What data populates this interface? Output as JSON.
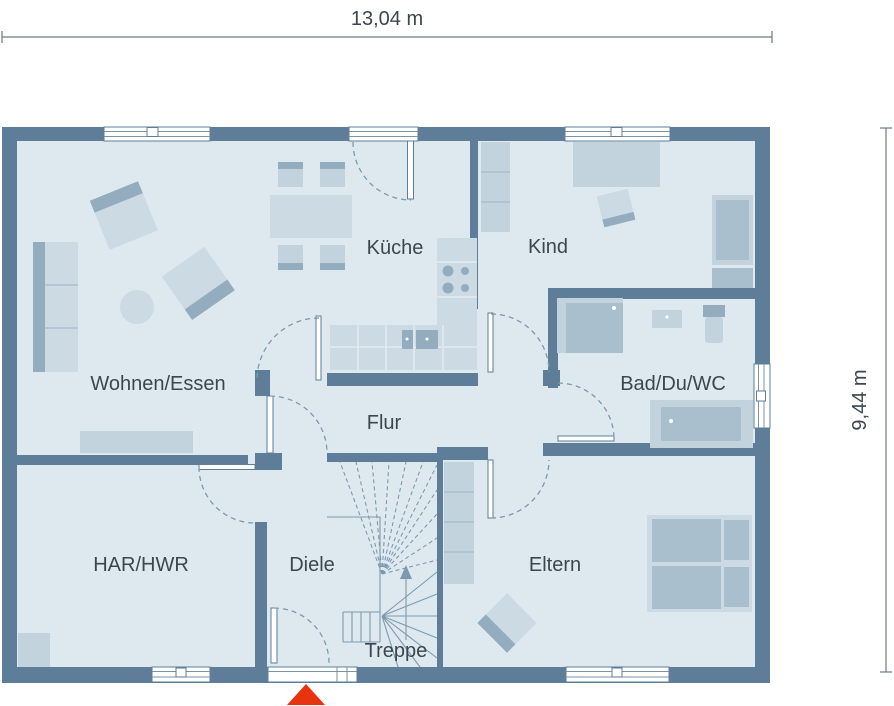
{
  "plan": {
    "type": "floor-plan",
    "dimensions": {
      "width_label": "13,04 m",
      "height_label": "9,44 m"
    },
    "rooms": [
      {
        "id": "wohnen-essen",
        "label": "Wohnen/Essen"
      },
      {
        "id": "kueche",
        "label": "Küche"
      },
      {
        "id": "kind",
        "label": "Kind"
      },
      {
        "id": "bad-du-wc",
        "label": "Bad/Du/WC"
      },
      {
        "id": "flur",
        "label": "Flur"
      },
      {
        "id": "har-hwr",
        "label": "HAR/HWR"
      },
      {
        "id": "diele",
        "label": "Diele"
      },
      {
        "id": "treppe",
        "label": "Treppe"
      },
      {
        "id": "eltern",
        "label": "Eltern"
      }
    ],
    "icons": {
      "entrance_marker": "red-triangle-entrance-arrow",
      "stair_direction": "up-arrow"
    },
    "colors": {
      "wall": "#5d7d98",
      "floor": "#dde9ef",
      "furniture_light": "#ccdae4",
      "furniture_medium": "#c3d3de",
      "furniture_dark": "#93adbf",
      "label_text": "#3c464e",
      "entrance_accent": "#e7330e"
    }
  }
}
